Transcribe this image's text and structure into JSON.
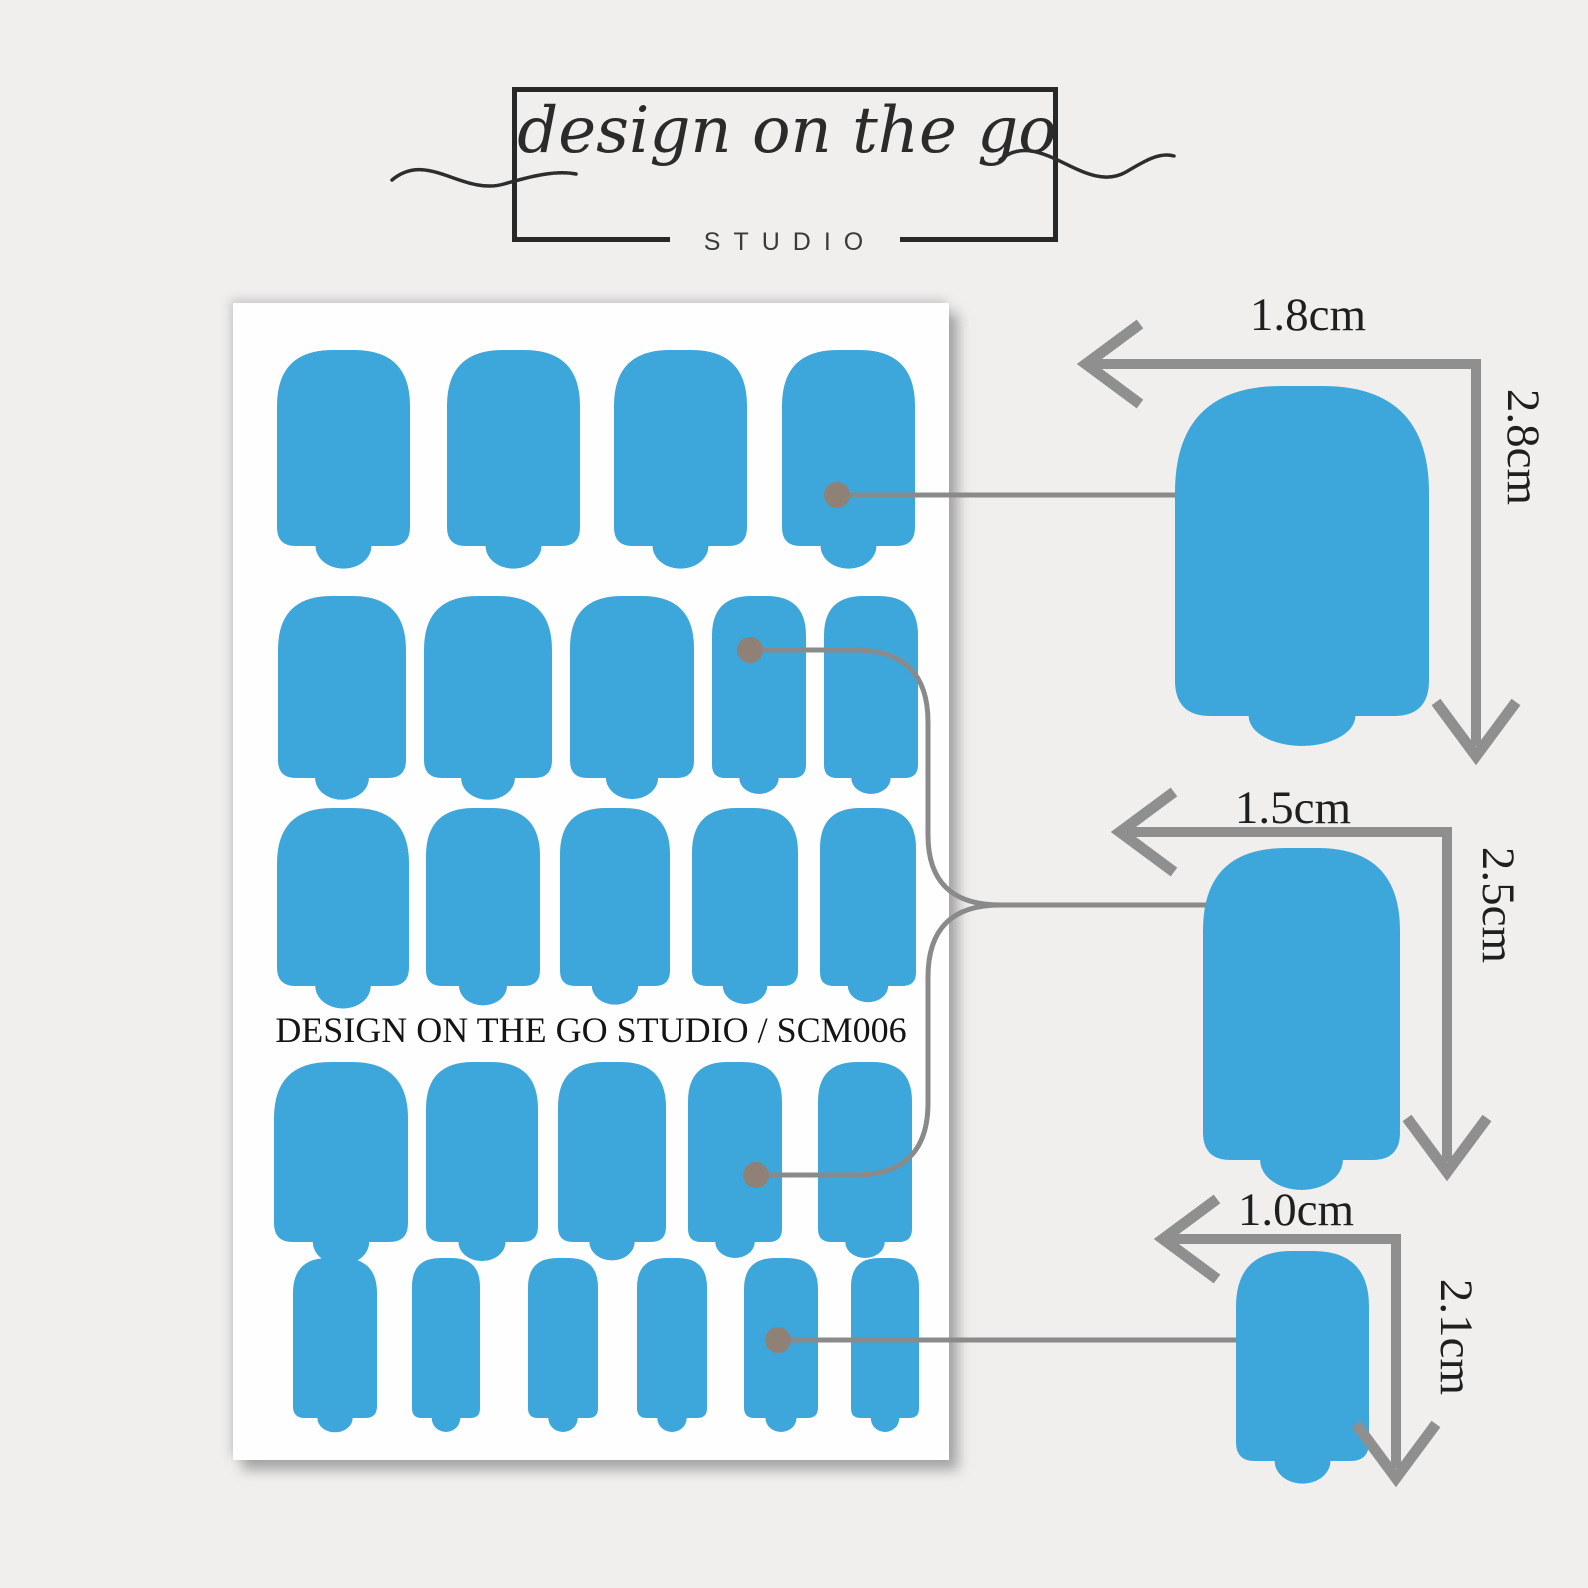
{
  "logo": {
    "script_text": "design on the go",
    "subtext": "STUDIO"
  },
  "sheet": {
    "label": "DESIGN ON THE GO STUDIO / SCM006",
    "x": 233,
    "y": 303,
    "w": 716,
    "h": 1157,
    "rows": [
      {
        "y": 350,
        "h": 196,
        "shapes": [
          {
            "x": 277,
            "w": 133
          },
          {
            "x": 447,
            "w": 133
          },
          {
            "x": 614,
            "w": 133
          },
          {
            "x": 782,
            "w": 133
          }
        ]
      },
      {
        "y": 596,
        "h": 182,
        "shapes": [
          {
            "x": 278,
            "w": 128
          },
          {
            "x": 424,
            "w": 128
          },
          {
            "x": 570,
            "w": 124
          },
          {
            "x": 712,
            "w": 94
          },
          {
            "x": 824,
            "w": 94
          }
        ]
      },
      {
        "y": 808,
        "h": 178,
        "shapes": [
          {
            "x": 277,
            "w": 132
          },
          {
            "x": 426,
            "w": 114
          },
          {
            "x": 560,
            "w": 110
          },
          {
            "x": 692,
            "w": 106
          },
          {
            "x": 820,
            "w": 96
          }
        ]
      },
      {
        "y": 1062,
        "h": 180,
        "shapes": [
          {
            "x": 274,
            "w": 134
          },
          {
            "x": 426,
            "w": 112
          },
          {
            "x": 558,
            "w": 108
          },
          {
            "x": 688,
            "w": 94
          },
          {
            "x": 818,
            "w": 94
          }
        ]
      },
      {
        "y": 1258,
        "h": 160,
        "shapes": [
          {
            "x": 293,
            "w": 84
          },
          {
            "x": 412,
            "w": 68
          },
          {
            "x": 528,
            "w": 70
          },
          {
            "x": 637,
            "w": 70
          },
          {
            "x": 744,
            "w": 74
          },
          {
            "x": 851,
            "w": 68
          }
        ]
      }
    ]
  },
  "samples": [
    {
      "id": "large",
      "width_label": "1.8cm",
      "height_label": "2.8cm",
      "shape": {
        "x": 1175,
        "y": 386,
        "w": 254,
        "h": 330
      },
      "dim": {
        "corner_x": 1476,
        "corner_y": 364,
        "left_tip_x": 1086,
        "down_tip_y": 756
      }
    },
    {
      "id": "medium",
      "width_label": "1.5cm",
      "height_label": "2.5cm",
      "shape": {
        "x": 1203,
        "y": 848,
        "w": 197,
        "h": 312
      },
      "dim": {
        "corner_x": 1447,
        "corner_y": 832,
        "left_tip_x": 1120,
        "down_tip_y": 1172
      }
    },
    {
      "id": "small",
      "width_label": "1.0cm",
      "height_label": "2.1cm",
      "shape": {
        "x": 1236,
        "y": 1251,
        "w": 133,
        "h": 210
      },
      "dim": {
        "corner_x": 1396,
        "corner_y": 1239,
        "left_tip_x": 1163,
        "down_tip_y": 1478
      }
    }
  ],
  "connectors": [
    {
      "id": "large-link",
      "from_dot": [
        837,
        495
      ],
      "to_dot": [
        1224,
        495
      ],
      "path": "M 837 495 L 1224 495"
    },
    {
      "id": "medium-link-top",
      "from_dot": [
        750,
        650
      ],
      "to_dot": [
        1228,
        905
      ],
      "path": "M 750 650 H 855 Q 928 650 928 722 V 835 Q 928 905 1000 905 H 1228"
    },
    {
      "id": "medium-link-bottom",
      "from_dot": [
        756,
        1175
      ],
      "to_dot": [
        1228,
        905
      ],
      "path": "M 756 1175 H 855 Q 928 1175 928 1103 V 977 Q 928 905 1000 905"
    },
    {
      "id": "small-link",
      "from_dot": [
        778,
        1340
      ],
      "to_dot": [
        1280,
        1340
      ],
      "path": "M 778 1340 L 1280 1340"
    }
  ],
  "colors": {
    "background": "#f0efee",
    "sheet": "#fefefe",
    "decal_blue": "#3da7db",
    "dimension_gray": "#8f8f8f",
    "connector_gray": "#8a8a8a",
    "dot_taupe": "#8f8176",
    "text_dark": "#1f1f1f",
    "logo_ink": "#2b2b2b"
  }
}
